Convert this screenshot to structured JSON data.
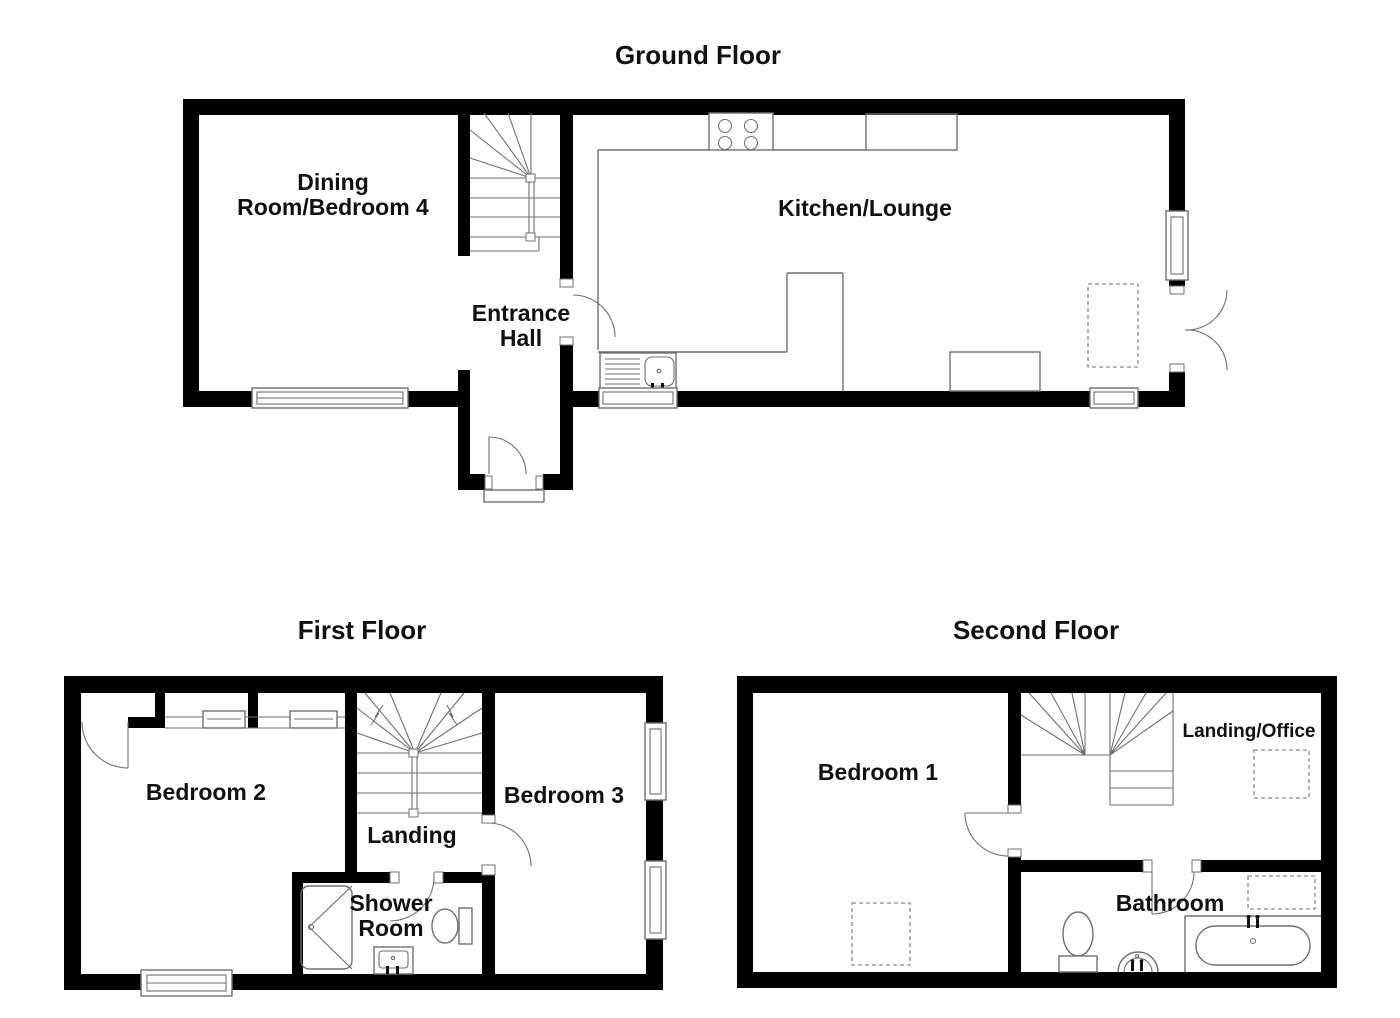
{
  "document": {
    "type": "floor-plan"
  },
  "colors": {
    "wall": "#000000",
    "fixture": "#6f6f6f",
    "text": "#111111",
    "background": "#ffffff"
  },
  "floors": {
    "ground": {
      "title": "Ground Floor",
      "rooms": {
        "dining_line1": "Dining",
        "dining_line2": "Room/Bedroom 4",
        "kitchen": "Kitchen/Lounge",
        "hall_line1": "Entrance",
        "hall_line2": "Hall"
      }
    },
    "first": {
      "title": "First Floor",
      "rooms": {
        "bedroom2": "Bedroom 2",
        "landing": "Landing",
        "shower_line1": "Shower",
        "shower_line2": "Room",
        "bedroom3": "Bedroom 3"
      }
    },
    "second": {
      "title": "Second Floor",
      "rooms": {
        "bedroom1": "Bedroom 1",
        "landing_office": "Landing/Office",
        "bathroom": "Bathroom"
      }
    }
  }
}
